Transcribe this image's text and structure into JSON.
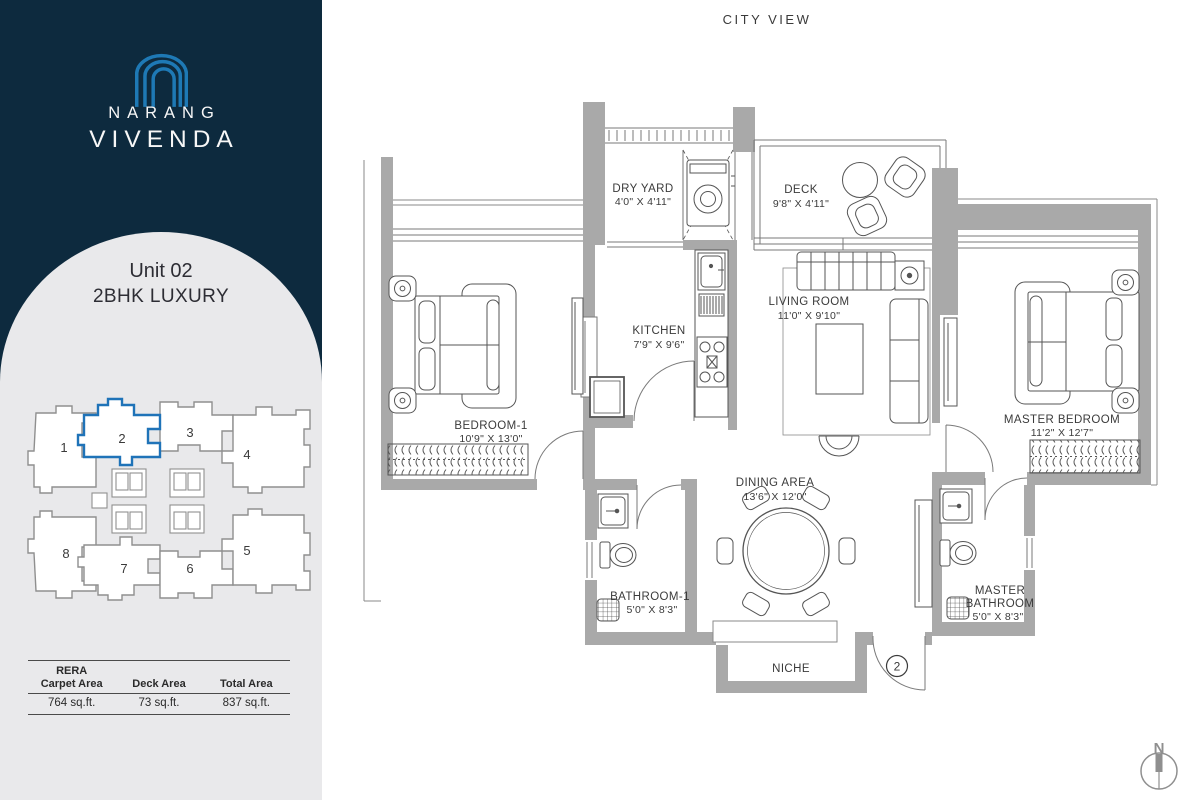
{
  "colors": {
    "navy": "#0d2a3e",
    "logo_blue": "#1e79b5",
    "arch_gray": "#e9e9eb",
    "wall_gray": "#a9a9a9",
    "highlight_blue": "#1f73b8",
    "text_dark": "#3b3b3b"
  },
  "brand": {
    "line1": "NARANG",
    "line2": "VIVENDA"
  },
  "unit": {
    "title": "Unit 02",
    "subtitle": "2BHK LUXURY"
  },
  "key_plan": {
    "units": [
      "1",
      "2",
      "3",
      "4",
      "5",
      "6",
      "7",
      "8"
    ],
    "highlighted": "2"
  },
  "area_table": {
    "col1_label_line1": "RERA",
    "col1_label_line2": "Carpet Area",
    "col2_label": "Deck Area",
    "col3_label": "Total Area",
    "col1_value": "764 sq.ft.",
    "col2_value": "73 sq.ft.",
    "col3_value": "837 sq.ft."
  },
  "plan": {
    "city_view": "CITY VIEW",
    "north": "N",
    "entrance_unit": "2",
    "rooms": {
      "dry_yard": {
        "name": "DRY YARD",
        "dims": "4'0\" X 4'11\""
      },
      "deck": {
        "name": "DECK",
        "dims": "9'8\" X 4'11\""
      },
      "kitchen": {
        "name": "KITCHEN",
        "dims": "7'9\" X 9'6\""
      },
      "living": {
        "name": "LIVING ROOM",
        "dims": "11'0\" X 9'10\""
      },
      "bedroom1": {
        "name": "BEDROOM-1",
        "dims": "10'9\" X 13'0\""
      },
      "master_bedroom": {
        "name": "MASTER BEDROOM",
        "dims": "11'2\" X 12'7\""
      },
      "dining": {
        "name": "DINING AREA",
        "dims": "13'6\" X 12'0\""
      },
      "bathroom1": {
        "name": "BATHROOM-1",
        "dims": "5'0\" X 8'3\""
      },
      "master_bathroom": {
        "name_line1": "MASTER",
        "name_line2": "BATHROOM",
        "dims": "5'0\" X 8'3\""
      },
      "niche": {
        "name": "NICHE"
      }
    }
  }
}
